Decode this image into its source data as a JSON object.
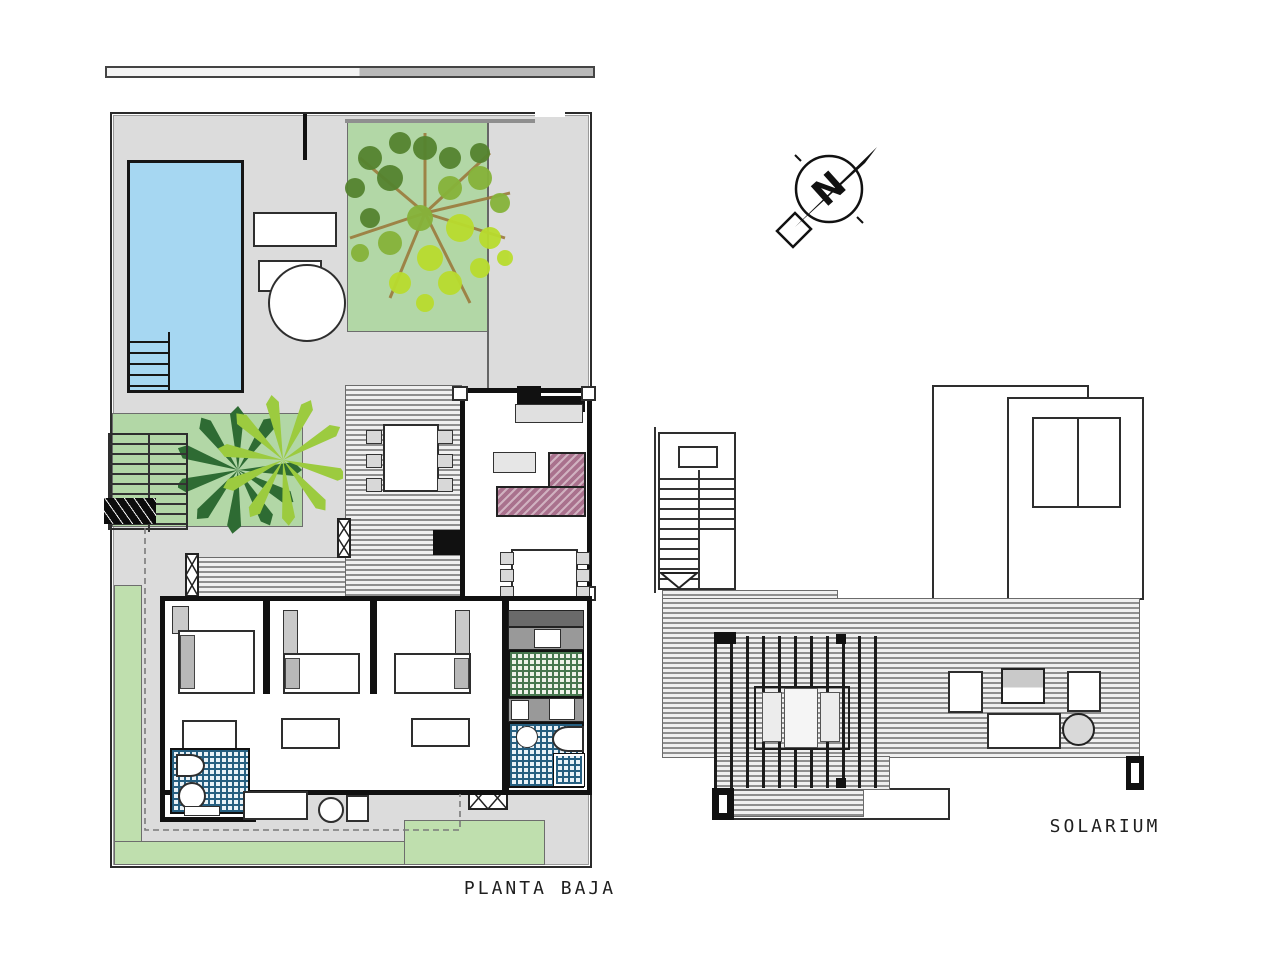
{
  "labels": {
    "ground_floor": "PLANTA BAJA",
    "solarium": "SOLARIUM"
  },
  "compass": {
    "letter": "N"
  },
  "icons": {
    "north_arrow": "compass-north-arrow-icon",
    "deciduous_tree": "tree-top-view-icon",
    "palm_tree": "palm-tree-top-view-icon",
    "window_symbol": "window-opening-icon"
  },
  "colors": {
    "plot_gray": "#dcdcdc",
    "outline": "#2b2b2b",
    "pool_blue": "#a6d7f2",
    "lawn_green": "#b2d7a6",
    "lawn_green_2": "#bfdfae",
    "deck_light": "#f0f0f0",
    "deck_dark": "#8f8f8f",
    "wall_black": "#111111",
    "sofa_mauve": "#a9718d",
    "tile_green": "#47774f",
    "tile_green_bg": "#eef2e9",
    "tile_blue": "#265f80",
    "tile_blue_bg": "#e9f2f7",
    "furniture_gray": "#d6d6d6",
    "counter_gray": "#999999",
    "counter_dark": "#6a6a6a",
    "ink": "#1f1f1f",
    "tree_dark": "#55832f",
    "tree_mid": "#86b33a",
    "tree_light": "#b9dc2e",
    "branch": "#9b7b3c",
    "palm_dark": "#2e6b33",
    "palm_light": "#9ccb3f"
  }
}
